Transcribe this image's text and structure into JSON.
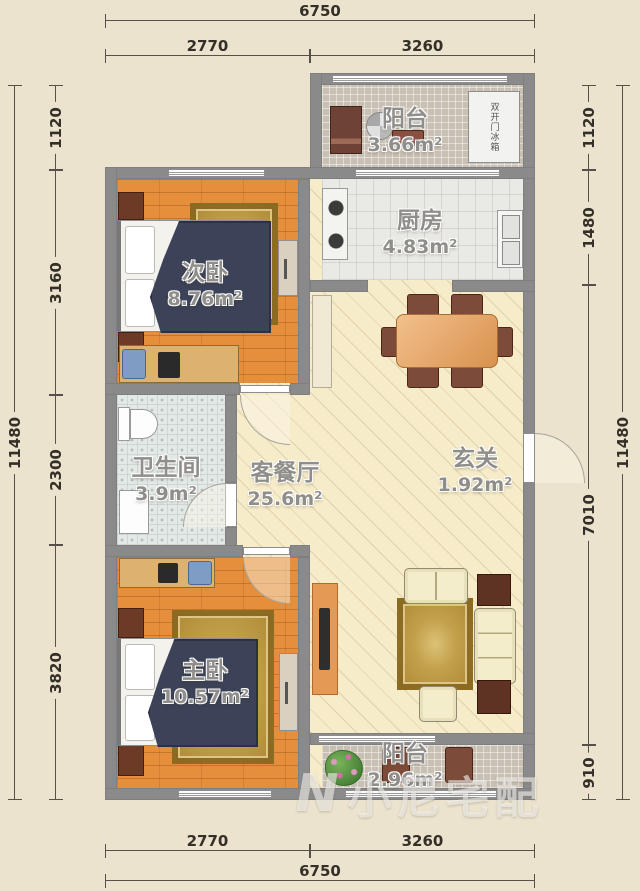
{
  "plan_title": "两室一厅户型图",
  "rooms": {
    "balcony_top": {
      "name": "阳台",
      "area": "3.66m²"
    },
    "kitchen": {
      "name": "厨房",
      "area": "4.83m²"
    },
    "bedroom_second": {
      "name": "次卧",
      "area": "8.76m²"
    },
    "bathroom": {
      "name": "卫生间",
      "area": "3.9m²"
    },
    "living_dining": {
      "name": "客餐厅",
      "area": "25.6m²"
    },
    "entry": {
      "name": "玄关",
      "area": "1.92m²"
    },
    "bedroom_master": {
      "name": "主卧",
      "area": "10.57m²"
    },
    "balcony_bottom": {
      "name": "阳台",
      "area": "2.96m²"
    }
  },
  "appliances": {
    "fridge_label": "双开门冰箱"
  },
  "dimensions": {
    "top": {
      "overall": "6750",
      "seg1": "2770",
      "seg2": "3260"
    },
    "bottom": {
      "overall": "6750",
      "seg1": "2770",
      "seg2": "3260"
    },
    "left": {
      "overall": "11480",
      "seg1": "1120",
      "seg2": "3160",
      "seg3": "2300",
      "seg4": "3820"
    },
    "right": {
      "overall": "11480",
      "seg1": "1120",
      "seg2": "1480",
      "seg3": "7010",
      "seg4": "910"
    }
  },
  "watermark": {
    "logo": "N",
    "text": "小尼宅配"
  },
  "colors": {
    "paper_background": "#ebe3cd",
    "wall_gray": "#8a8a8a",
    "wood_floor_orange": "#e58f3c",
    "living_floor_cream": "#f6ecca",
    "balcony_tile_gray": "#c9c0b4",
    "bed_cover_navy": "#3c4257",
    "rug_gold": "#c3a14c",
    "furniture_brown": "#7c4b39",
    "sofa_cream": "#f3edcc",
    "dimension_text": "#343028"
  }
}
